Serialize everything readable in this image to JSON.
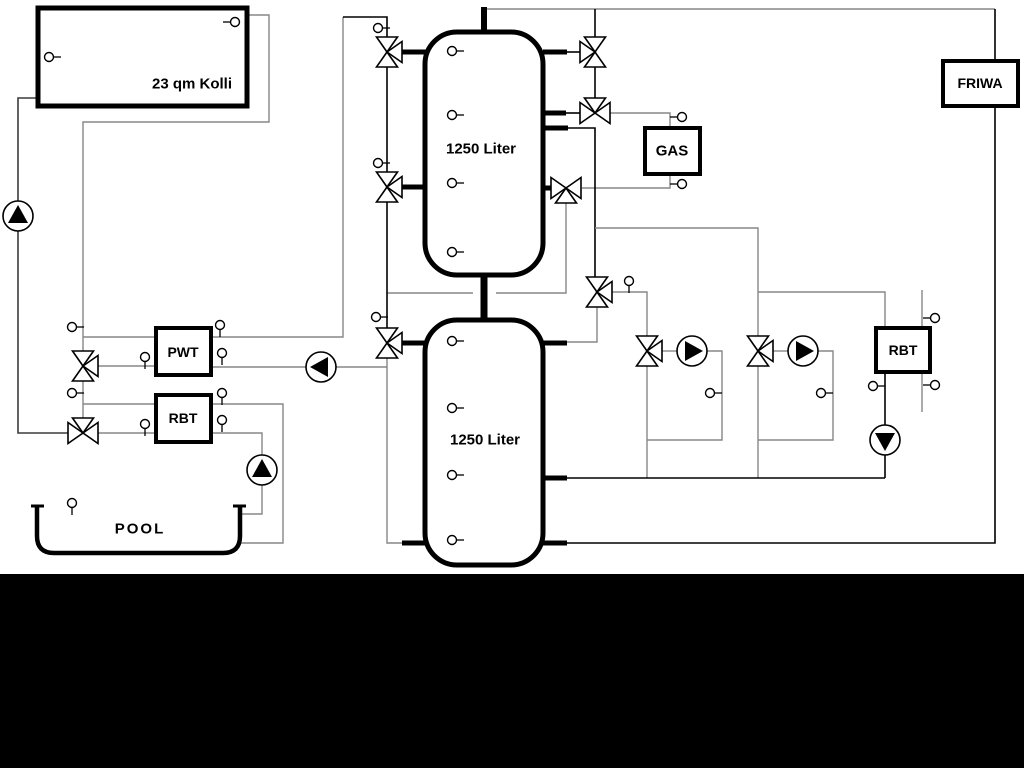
{
  "diagram": {
    "title_hint": "hydraulic heating schematic",
    "collector": {
      "label": "23 qm Kolli"
    },
    "upper_tank": {
      "label": "1250 Liter"
    },
    "lower_tank": {
      "label": "1250 Liter"
    },
    "gas_boiler": {
      "label": "GAS"
    },
    "friwa_station": {
      "label": "FRIWA"
    },
    "pool_heat_exchanger": {
      "label": "PWT"
    },
    "left_heat_exchanger": {
      "label": "RBT"
    },
    "right_heat_exchanger": {
      "label": "RBT"
    },
    "pool": {
      "label": "POOL"
    }
  },
  "icons": {
    "pump": "circle-with-filled-triangle",
    "three_way_valve": "three-open-triangles-meeting-at-center",
    "sensor": "small-circle-with-stub"
  },
  "colors": {
    "pipe_gray": "#878787",
    "pipe_black": "#000000",
    "pipe_dark": "#3c3c3c",
    "component_border": "#000000",
    "background": "#ffffff",
    "bottom_mask": "#000000"
  }
}
